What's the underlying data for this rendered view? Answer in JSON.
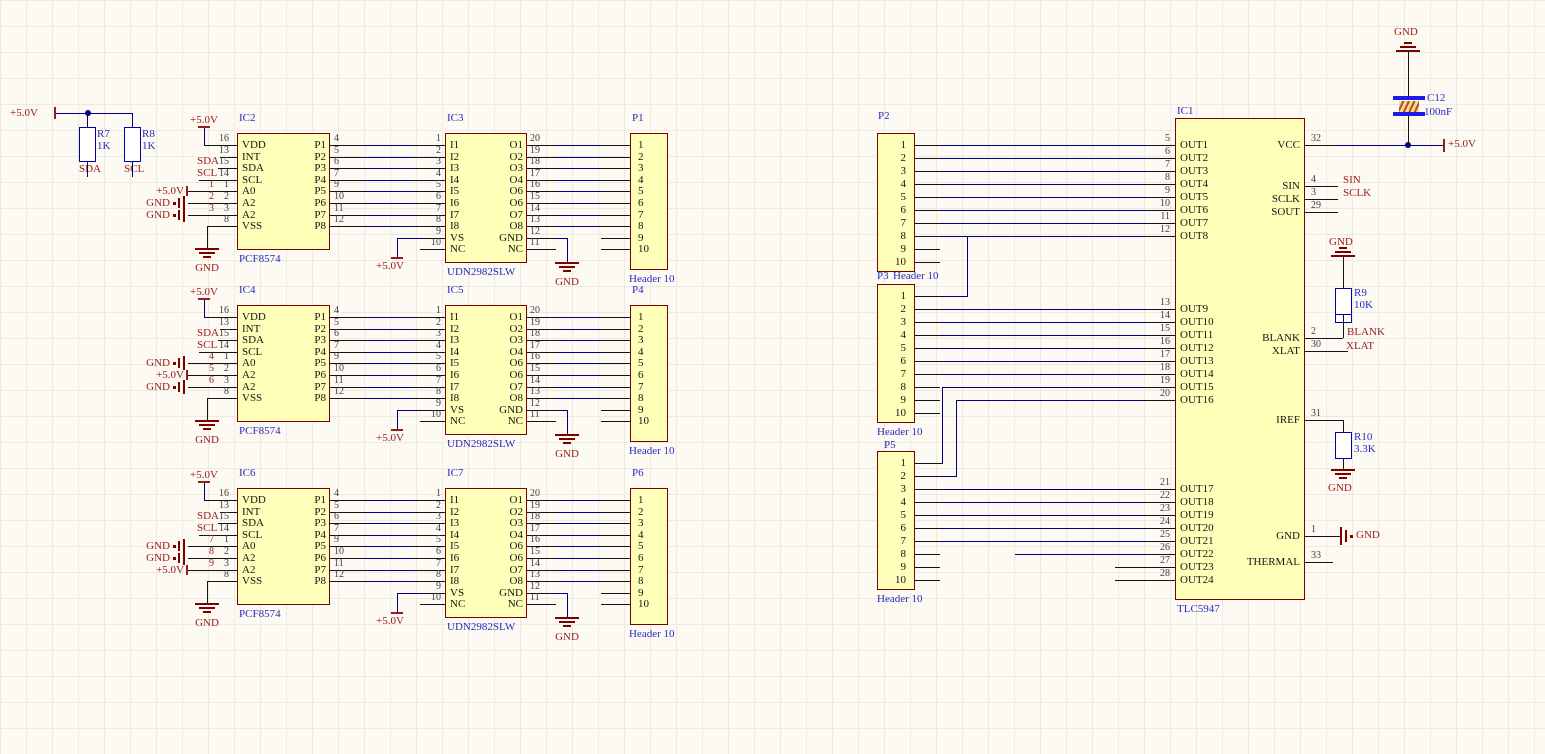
{
  "canvas": {
    "width": 1545,
    "height": 754,
    "bg": "#FCFAF2",
    "grid": "#ECEAE1",
    "wire_blue": "#00007E",
    "wire_black": "#141414",
    "body_fill": "#FFFFB9",
    "body_border": "#7B0000",
    "text_blue": "#2929BE",
    "text_red": "#9A1A1A"
  },
  "pullups": {
    "rail": "+5.0V",
    "resistors": [
      {
        "designator": "R7",
        "value": "1K",
        "net": "SDA"
      },
      {
        "designator": "R8",
        "value": "1K",
        "net": "SCL"
      }
    ]
  },
  "left_rows": [
    {
      "expander": {
        "designator": "IC2",
        "comment": "PCF8574",
        "left_pins": [
          [
            "VDD",
            "16"
          ],
          [
            "INT",
            "13"
          ],
          [
            "SDA",
            "15"
          ],
          [
            "SCL",
            "14"
          ],
          [
            "A0",
            "1"
          ],
          [
            "A2",
            "2"
          ],
          [
            "A2",
            "3"
          ],
          [
            "VSS",
            "8"
          ]
        ],
        "right_pins": [
          [
            "P1",
            "4"
          ],
          [
            "P2",
            "5"
          ],
          [
            "P3",
            "6"
          ],
          [
            "P4",
            "7"
          ],
          [
            "P5",
            "9"
          ],
          [
            "P6",
            "10"
          ],
          [
            "P7",
            "11"
          ],
          [
            "P8",
            "12"
          ]
        ],
        "net_labels": [
          "SDA",
          "SCL"
        ],
        "addr_ports": [
          [
            "+5.0V",
            "1"
          ],
          [
            "GND",
            "2"
          ],
          [
            "GND",
            "3"
          ]
        ],
        "top_rail": "+5.0V",
        "gnd": "GND"
      },
      "driver": {
        "designator": "IC3",
        "comment": "UDN2982SLW",
        "in_pins": [
          [
            "I1",
            "1"
          ],
          [
            "I2",
            "2"
          ],
          [
            "I3",
            "3"
          ],
          [
            "I4",
            "4"
          ],
          [
            "I5",
            "5"
          ],
          [
            "I6",
            "6"
          ],
          [
            "I7",
            "7"
          ],
          [
            "I8",
            "8"
          ],
          [
            "VS",
            "9"
          ],
          [
            "NC",
            "10"
          ]
        ],
        "out_pins": [
          [
            "O1",
            "20"
          ],
          [
            "O2",
            "19"
          ],
          [
            "O3",
            "18"
          ],
          [
            "O4",
            "17"
          ],
          [
            "O6",
            "16"
          ],
          [
            "O6",
            "15"
          ],
          [
            "O7",
            "14"
          ],
          [
            "O8",
            "13"
          ],
          [
            "GND",
            "12"
          ],
          [
            "NC",
            "11"
          ]
        ],
        "rail": "+5.0V",
        "gnd": "GND"
      },
      "header": {
        "designator": "P1",
        "comment": "Header 10",
        "pins": [
          "1",
          "2",
          "3",
          "4",
          "5",
          "6",
          "7",
          "8",
          "9",
          "10"
        ]
      }
    },
    {
      "expander": {
        "designator": "IC4",
        "comment": "PCF8574",
        "left_pins": [
          [
            "VDD",
            "16"
          ],
          [
            "INT",
            "13"
          ],
          [
            "SDA",
            "15"
          ],
          [
            "SCL",
            "14"
          ],
          [
            "A0",
            "1"
          ],
          [
            "A2",
            "2"
          ],
          [
            "A2",
            "3"
          ],
          [
            "VSS",
            "8"
          ]
        ],
        "right_pins": [
          [
            "P1",
            "4"
          ],
          [
            "P2",
            "5"
          ],
          [
            "P3",
            "6"
          ],
          [
            "P4",
            "7"
          ],
          [
            "P5",
            "9"
          ],
          [
            "P6",
            "10"
          ],
          [
            "P7",
            "11"
          ],
          [
            "P8",
            "12"
          ]
        ],
        "net_labels": [
          "SDA",
          "SCL"
        ],
        "addr_ports": [
          [
            "GND",
            "4"
          ],
          [
            "+5.0V",
            "5"
          ],
          [
            "GND",
            "6"
          ]
        ],
        "top_rail": "+5.0V",
        "gnd": "GND"
      },
      "driver": {
        "designator": "IC5",
        "comment": "UDN2982SLW",
        "in_pins": [
          [
            "I1",
            "1"
          ],
          [
            "I2",
            "2"
          ],
          [
            "I3",
            "3"
          ],
          [
            "I4",
            "4"
          ],
          [
            "I5",
            "5"
          ],
          [
            "I6",
            "6"
          ],
          [
            "I7",
            "7"
          ],
          [
            "I8",
            "8"
          ],
          [
            "VS",
            "9"
          ],
          [
            "NC",
            "10"
          ]
        ],
        "out_pins": [
          [
            "O1",
            "20"
          ],
          [
            "O2",
            "19"
          ],
          [
            "O3",
            "18"
          ],
          [
            "O4",
            "17"
          ],
          [
            "O6",
            "16"
          ],
          [
            "O6",
            "15"
          ],
          [
            "O7",
            "14"
          ],
          [
            "O8",
            "13"
          ],
          [
            "GND",
            "12"
          ],
          [
            "NC",
            "11"
          ]
        ],
        "rail": "+5.0V",
        "gnd": "GND"
      },
      "header": {
        "designator": "P4",
        "comment": "Header 10",
        "pins": [
          "1",
          "2",
          "3",
          "4",
          "5",
          "6",
          "7",
          "8",
          "9",
          "10"
        ]
      }
    },
    {
      "expander": {
        "designator": "IC6",
        "comment": "PCF8574",
        "left_pins": [
          [
            "VDD",
            "16"
          ],
          [
            "INT",
            "13"
          ],
          [
            "SDA",
            "15"
          ],
          [
            "SCL",
            "14"
          ],
          [
            "A0",
            "1"
          ],
          [
            "A2",
            "2"
          ],
          [
            "A2",
            "3"
          ],
          [
            "VSS",
            "8"
          ]
        ],
        "right_pins": [
          [
            "P1",
            "4"
          ],
          [
            "P2",
            "5"
          ],
          [
            "P3",
            "6"
          ],
          [
            "P4",
            "7"
          ],
          [
            "P5",
            "9"
          ],
          [
            "P6",
            "10"
          ],
          [
            "P7",
            "11"
          ],
          [
            "P8",
            "12"
          ]
        ],
        "net_labels": [
          "SDA",
          "SCL"
        ],
        "addr_ports": [
          [
            "GND",
            "7"
          ],
          [
            "GND",
            "8"
          ],
          [
            "+5.0V",
            "9"
          ]
        ],
        "top_rail": "+5.0V",
        "gnd": "GND"
      },
      "driver": {
        "designator": "IC7",
        "comment": "UDN2982SLW",
        "in_pins": [
          [
            "I1",
            "1"
          ],
          [
            "I2",
            "2"
          ],
          [
            "I3",
            "3"
          ],
          [
            "I4",
            "4"
          ],
          [
            "I5",
            "5"
          ],
          [
            "I6",
            "6"
          ],
          [
            "I7",
            "7"
          ],
          [
            "I8",
            "8"
          ],
          [
            "VS",
            "9"
          ],
          [
            "NC",
            "10"
          ]
        ],
        "out_pins": [
          [
            "O1",
            "20"
          ],
          [
            "O2",
            "19"
          ],
          [
            "O3",
            "18"
          ],
          [
            "O4",
            "17"
          ],
          [
            "O6",
            "16"
          ],
          [
            "O6",
            "15"
          ],
          [
            "O7",
            "14"
          ],
          [
            "O8",
            "13"
          ],
          [
            "GND",
            "12"
          ],
          [
            "NC",
            "11"
          ]
        ],
        "rail": "+5.0V",
        "gnd": "GND"
      },
      "header": {
        "designator": "P6",
        "comment": "Header 10",
        "pins": [
          "1",
          "2",
          "3",
          "4",
          "5",
          "6",
          "7",
          "8",
          "9",
          "10"
        ]
      }
    }
  ],
  "right_headers": [
    {
      "designator": "P2",
      "comment": "Header 10",
      "pins": [
        "1",
        "2",
        "3",
        "4",
        "5",
        "6",
        "7",
        "8",
        "9",
        "10"
      ]
    },
    {
      "designator": "P3",
      "comment": "Header 10",
      "pins": [
        "1",
        "2",
        "3",
        "4",
        "5",
        "6",
        "7",
        "8",
        "9",
        "10"
      ]
    },
    {
      "designator": "P5",
      "comment": "Header 10",
      "pins": [
        "1",
        "2",
        "3",
        "4",
        "5",
        "6",
        "7",
        "8",
        "9",
        "10"
      ]
    }
  ],
  "tlc": {
    "designator": "IC1",
    "comment": "TLC5947",
    "outs_a": [
      [
        "OUT1",
        "5"
      ],
      [
        "OUT2",
        "6"
      ],
      [
        "OUT3",
        "7"
      ],
      [
        "OUT4",
        "8"
      ],
      [
        "OUT5",
        "9"
      ],
      [
        "OUT6",
        "10"
      ],
      [
        "OUT7",
        "11"
      ],
      [
        "OUT8",
        "12"
      ]
    ],
    "outs_b": [
      [
        "OUT9",
        "13"
      ],
      [
        "OUT10",
        "14"
      ],
      [
        "OUT11",
        "15"
      ],
      [
        "OUT12",
        "16"
      ],
      [
        "OUT13",
        "17"
      ],
      [
        "OUT14",
        "18"
      ],
      [
        "OUT15",
        "19"
      ],
      [
        "OUT16",
        "20"
      ]
    ],
    "outs_c": [
      [
        "OUT17",
        "21"
      ],
      [
        "OUT18",
        "22"
      ],
      [
        "OUT19",
        "23"
      ],
      [
        "OUT20",
        "24"
      ],
      [
        "OUT21",
        "25"
      ],
      [
        "OUT22",
        "26"
      ],
      [
        "OUT23",
        "27"
      ],
      [
        "OUT24",
        "28"
      ]
    ],
    "vcc": [
      "VCC",
      "32"
    ],
    "sin": [
      "SIN",
      "4"
    ],
    "sclk": [
      "SCLK",
      "3"
    ],
    "sout": [
      "SOUT",
      "29"
    ],
    "blank": [
      "BLANK",
      "2"
    ],
    "xlat": [
      "XLAT",
      "30"
    ],
    "iref": [
      "IREF",
      "31"
    ],
    "gnd_pin": [
      "GND",
      "1"
    ],
    "thermal": [
      "THERMAL",
      "33"
    ],
    "labels": {
      "sin": "SIN",
      "sclk": "SCLK",
      "blank": "BLANK",
      "xlat": "XLAT",
      "rail": "+5.0V",
      "gnd": "GND"
    }
  },
  "decap": {
    "designator": "C12",
    "value": "100nF",
    "gnd": "GND"
  },
  "r9": {
    "designator": "R9",
    "value": "10K",
    "gnd": "GND"
  },
  "r10": {
    "designator": "R10",
    "value": "3.3K",
    "gnd": "GND"
  }
}
